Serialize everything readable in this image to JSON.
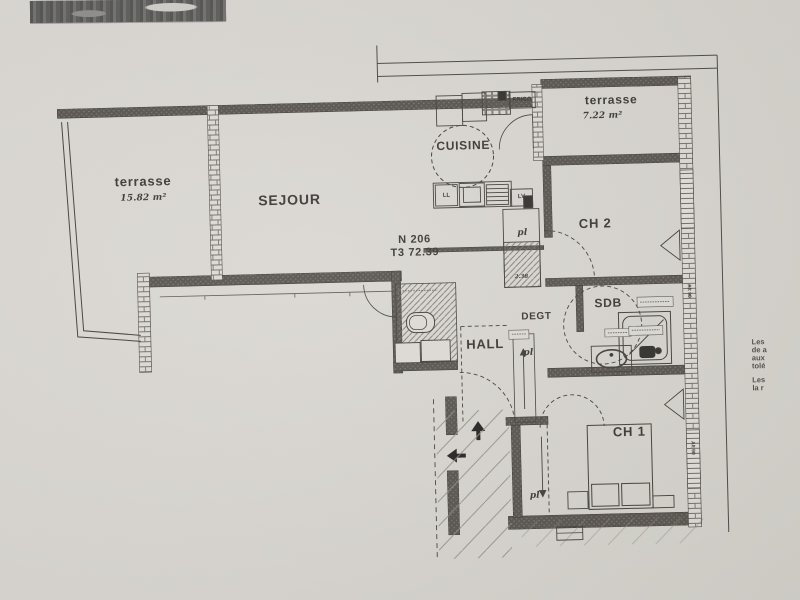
{
  "plan": {
    "unit": {
      "number": "N 206",
      "type_area": "T3 72.39"
    },
    "rooms": {
      "terrace_left": {
        "name": "terrasse",
        "area": "15.82 m²"
      },
      "living": {
        "name": "SEJOUR"
      },
      "kitchen": {
        "name": "CUISINE",
        "fridge": "FRIGO",
        "washer": "LL",
        "dishwasher": "LV"
      },
      "terrace_top": {
        "name": "terrasse",
        "area": "7.22 m²"
      },
      "bedroom2": {
        "name": "CH 2"
      },
      "bathroom": {
        "name": "SDB"
      },
      "corridor": {
        "name": "DEGT"
      },
      "hall": {
        "name": "HALL"
      },
      "bedroom1": {
        "name": "CH 1"
      }
    },
    "closet_label": "pl",
    "closet_dim": "2.38",
    "window_label": "Alt 90",
    "side_note_lines": [
      "Les",
      "de a",
      "aux",
      "tolé",
      "Les",
      "la r"
    ],
    "colors": {
      "paper": "#d8d5d0",
      "ink": "#3a3733",
      "wall_fill": "#514d48",
      "accent_dark": "#2b2926"
    }
  }
}
